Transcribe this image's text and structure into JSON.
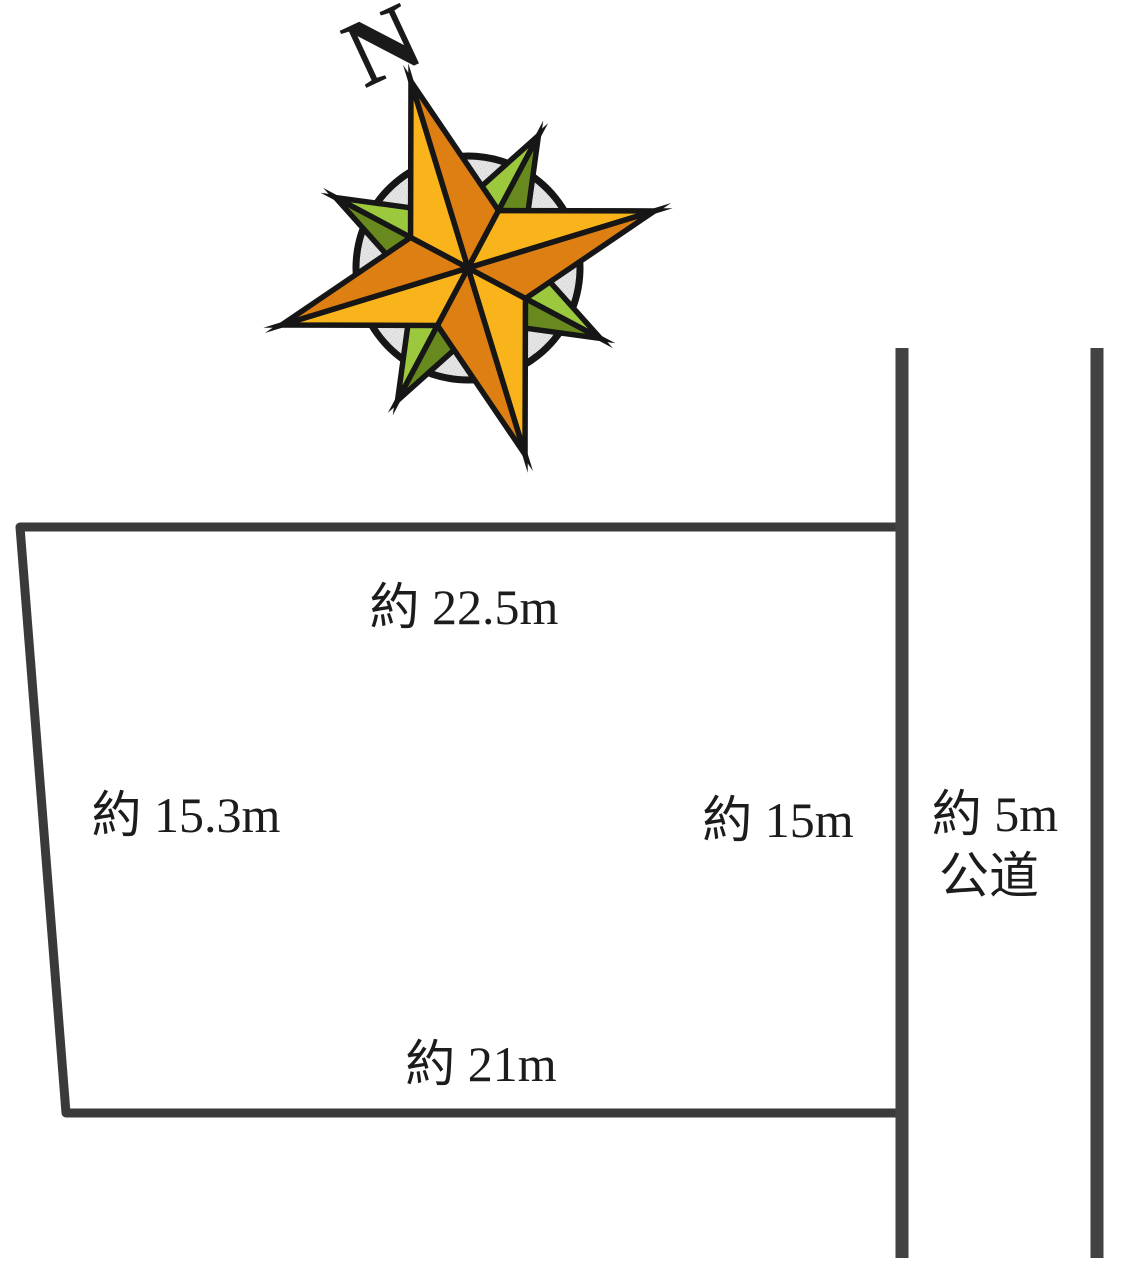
{
  "compass": {
    "north_label": "N",
    "colors": {
      "cardinal_light": "#F9B41C",
      "cardinal_dark": "#DD7F13",
      "diagonal_light": "#9CC83E",
      "diagonal_dark": "#68891D",
      "circle_fill": "#E3E3E3",
      "outline": "#161616"
    }
  },
  "plot": {
    "top_dimension": "約 22.5m",
    "left_dimension": "約 15.3m",
    "right_dimension": "約 15m",
    "bottom_dimension": "約 21m",
    "outline_color": "#3a3a3a"
  },
  "road": {
    "width_label": "約 5m",
    "type_label": "公道",
    "line_color": "#424242"
  }
}
